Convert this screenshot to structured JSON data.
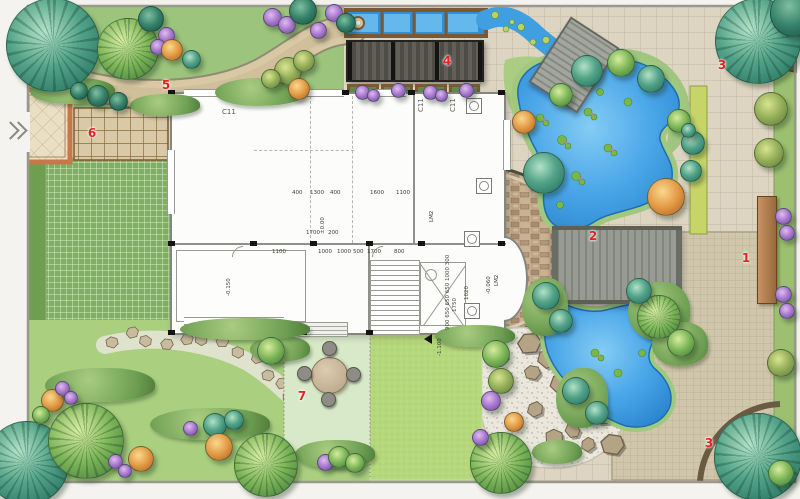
{
  "plan": {
    "area_markers": {
      "m1": "1",
      "m2": "2",
      "m3_top": "3",
      "m3_bottom": "3",
      "m4": "4",
      "m5": "5",
      "m6": "6",
      "m7": "7"
    },
    "floorplan": {
      "window_label_1": "C11",
      "window_label_2": "C11",
      "window_label_3": "C11",
      "door_label_1": "LM2",
      "door_label_2": "LM2",
      "elevation_main": "±0.00",
      "elevation_garage": "-0.150",
      "elevation_bay": "-0.060",
      "elevation_lawn": "-1.100",
      "dims_top": [
        "400",
        "1300",
        "400",
        "1600",
        "1100"
      ],
      "dims_mid": [
        "1100",
        "1000",
        "1000",
        "500",
        "1700",
        "800"
      ],
      "dims_inner": [
        "1700",
        "200"
      ],
      "dims_right": "900 650 650 650 1000 300",
      "dim_bay_1": "1020",
      "dim_bay_2": "1750"
    },
    "colors": {
      "water": "#3d9fe3",
      "lawn": "#aed17f",
      "paving": "#ddd5c1",
      "plaza": "#d0c6ab",
      "brick": "#c9b293",
      "marker_red": "#e82020",
      "deck_gray": "#8f938d",
      "pergola_gray": "#55544d",
      "wood": "#7a5a34",
      "tree_teal": "#2e7f6e",
      "tree_green": "#5a9e4a",
      "shrub_purple": "#a677cc",
      "shrub_orange": "#e29a45"
    }
  }
}
